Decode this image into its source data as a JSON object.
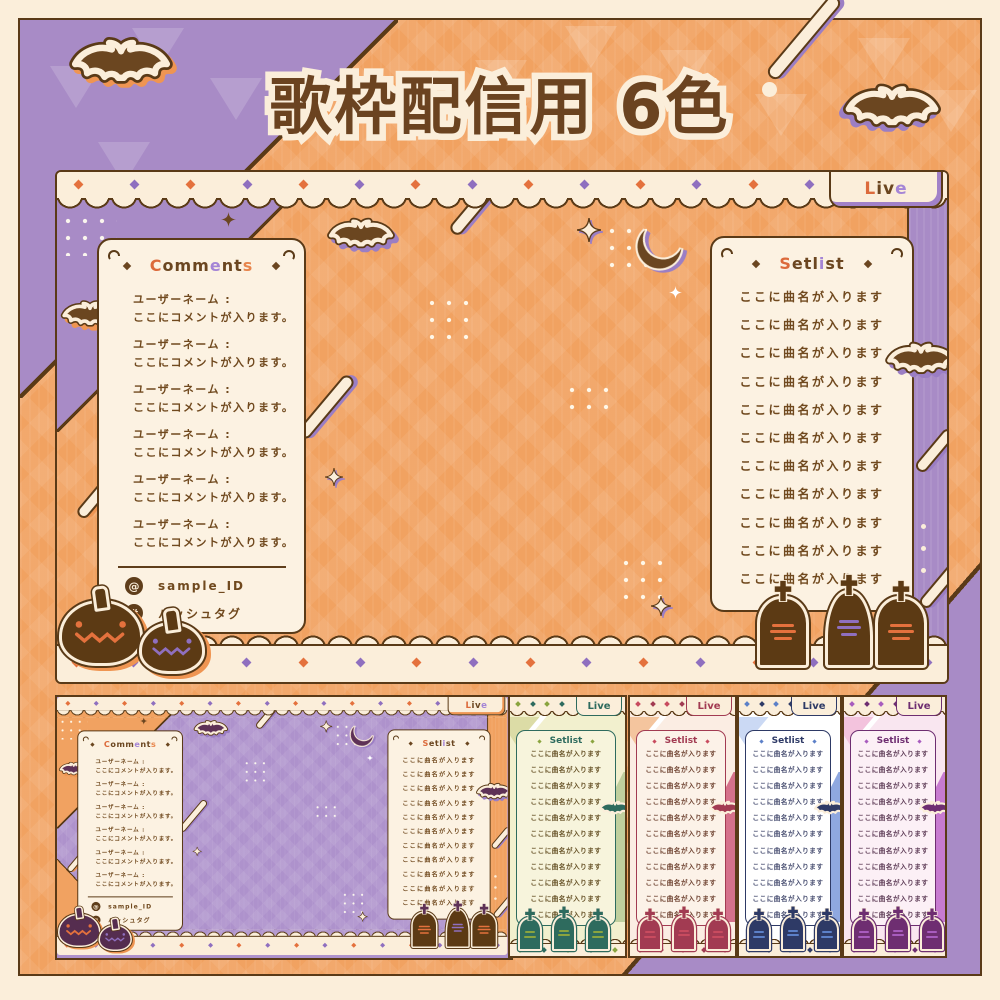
{
  "page": {
    "title": "歌枠配信用 6色"
  },
  "palette": {
    "cream": "#FBEEDA",
    "brown_dark": "#5A3A17",
    "text_brown": "#70491E",
    "orange": "#F1A261",
    "orange_accent": "#E4713D",
    "purple": "#A88BC6",
    "purple_accent": "#8F6FBF",
    "shadow_orange": "#EF9552",
    "shadow_purple": "#9B7EC4"
  },
  "overlay": {
    "live_tab": {
      "text": "Live",
      "letter_colors": [
        "#DC6A3B",
        "#6B4620",
        "#6B4620",
        "#A585D6"
      ]
    },
    "comments": {
      "title": {
        "text": "Comments",
        "letter_colors": [
          "#DC6A3B",
          "#6B4620",
          "#6B4620",
          "#6B4620",
          "#A585D6",
          "#6B4620",
          "#6B4620",
          "#E8854C"
        ]
      },
      "entries": [
        {
          "name": "ユーザーネーム :",
          "text": "ここにコメントが入ります。"
        },
        {
          "name": "ユーザーネーム :",
          "text": "ここにコメントが入ります。"
        },
        {
          "name": "ユーザーネーム :",
          "text": "ここにコメントが入ります。"
        },
        {
          "name": "ユーザーネーム :",
          "text": "ここにコメントが入ります。"
        },
        {
          "name": "ユーザーネーム :",
          "text": "ここにコメントが入ります。"
        },
        {
          "name": "ユーザーネーム :",
          "text": "ここにコメントが入ります。"
        }
      ],
      "footer": {
        "at_symbol": "@",
        "id": "sample_ID",
        "hash_symbol": "#",
        "hashtag": "ハッシュタグ"
      }
    },
    "setlist": {
      "title": {
        "text": "Setlist",
        "letter_colors": [
          "#DC6A3B",
          "#6B4620",
          "#6B4620",
          "#6B4620",
          "#A585D6",
          "#6B4620",
          "#6B4620"
        ]
      },
      "items": [
        "ここに曲名が入ります",
        "ここに曲名が入ります",
        "ここに曲名が入ります",
        "ここに曲名が入ります",
        "ここに曲名が入ります",
        "ここに曲名が入ります",
        "ここに曲名が入ります",
        "ここに曲名が入ります",
        "ここに曲名が入ります",
        "ここに曲名が入ります",
        "ここに曲名が入ります"
      ]
    }
  },
  "variants": [
    {
      "id": "purple",
      "bg": "#AE92CC",
      "accent": "#5E3156"
    },
    {
      "id": "green",
      "bg": "#F2F0CE",
      "accent": "#2E6B5E",
      "accent_bright": "#8AA43F",
      "band": "#BFCF9E",
      "triangle": "#DCDCA6"
    },
    {
      "id": "red",
      "bg": "#FBEDE3",
      "accent": "#A23B52",
      "accent_bright": "#C84B5F",
      "band": "#D5718B",
      "triangle": "#F4C59E"
    },
    {
      "id": "blue",
      "bg": "#FFFFFF",
      "accent": "#2E3A66",
      "accent_bright": "#5C80C8",
      "band": "#8FA8E0",
      "triangle": "#CBD9F4"
    },
    {
      "id": "pink",
      "bg": "#F9E6F0",
      "accent": "#6E2E71",
      "accent_bright": "#A85CBE",
      "band": "#C77BD0",
      "triangle": "#F3C3DD"
    }
  ]
}
